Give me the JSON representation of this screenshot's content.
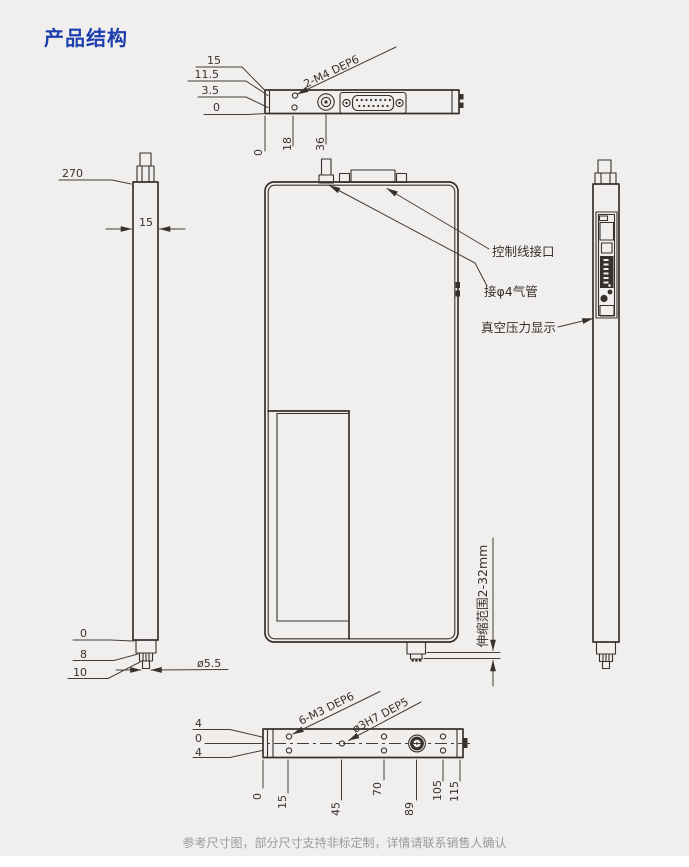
{
  "page": {
    "title": "产品结构",
    "footer": "参考尺寸图，部分尺寸支持非标定制，详情请联系销售人确认"
  },
  "colors": {
    "title_blue": "#1d3fae",
    "line": "#38302c",
    "background": "#f0efee",
    "footer_gray": "#9a9a9a"
  },
  "top_view": {
    "thread_label": "2-M4 DEP6",
    "edge_dims": [
      "15",
      "11.5",
      "3.5",
      "0"
    ],
    "position_dims": [
      "0",
      "18",
      "36"
    ]
  },
  "left_view": {
    "length_dim": "270",
    "width_dim": "15",
    "tip_dims": [
      "0",
      "8",
      "10"
    ],
    "tip_diameter": "ø5.5"
  },
  "front_view": {
    "label_control": "控制线接口",
    "label_air": "接φ4气管",
    "label_display": "真空压力显示",
    "stroke_range": "伸缩范围2-32mm"
  },
  "bottom_view": {
    "offset_dims": [
      "4",
      "0",
      "4"
    ],
    "thread_label": "6-M3 DEP6",
    "hole_label": "ø3H7 DEP5",
    "position_dims": [
      "0",
      "15",
      "45",
      "70",
      "89",
      "105",
      "115"
    ]
  }
}
